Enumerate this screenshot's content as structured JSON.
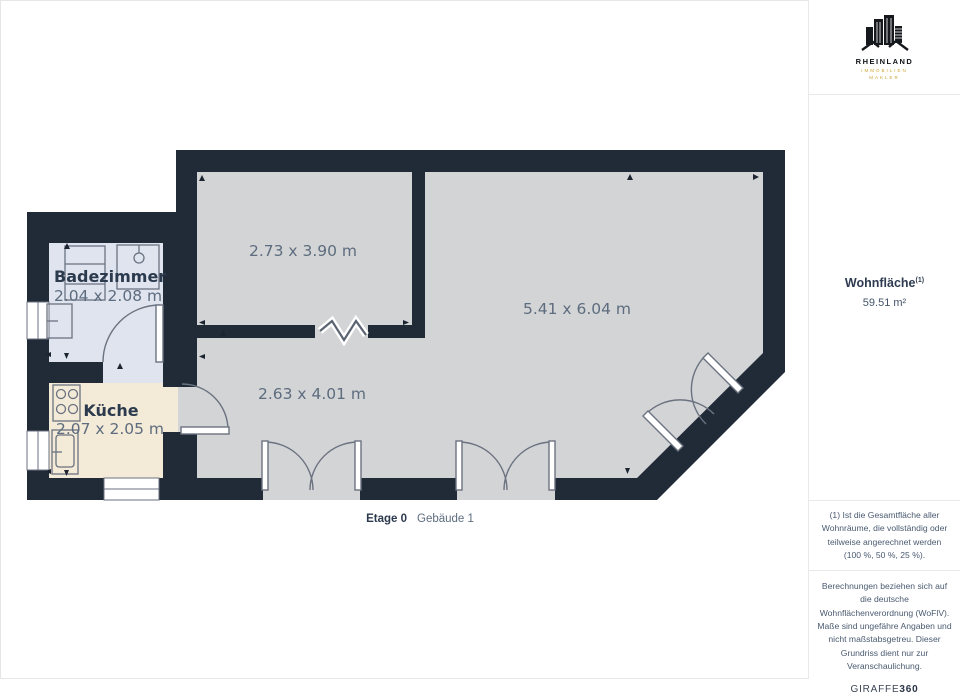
{
  "floorplan": {
    "rooms": [
      {
        "name": "Badezimmer",
        "dimensions": "2.04 x 2.08 m"
      },
      {
        "name": "Küche",
        "dimensions": "2.07 x 2.05 m"
      },
      {
        "name": "",
        "dimensions": "2.73 x 3.90 m"
      },
      {
        "name": "",
        "dimensions": "5.41 x 6.04 m"
      },
      {
        "name": "",
        "dimensions": "2.63 x 4.01 m"
      }
    ],
    "colors": {
      "wall": "#212b38",
      "floor": "#d3d4d6",
      "bathroom_floor": "#dfe4ef",
      "kitchen_floor": "#f3ead8",
      "door_line": "#6b7280",
      "label": "#2c3a4d",
      "dimension_text": "#5d6c7e"
    }
  },
  "caption": {
    "floor_label": "Etage 0",
    "building_label": "Gebäude 1"
  },
  "sidebar": {
    "logo": {
      "name": "RHEINLAND",
      "subtitle1": "IMMOBILIEN",
      "subtitle2": "MAKLER"
    },
    "area_title": "Wohnfläche",
    "area_superscript": "(1)",
    "area_value": "59.51 m²",
    "footnote1": "(1) Ist die Gesamtfläche aller Wohnräume, die vollständig oder teilweise angerechnet werden (100 %, 50 %, 25 %).",
    "footnote2": "Berechnungen beziehen sich auf die deutsche Wohnflächenverordnung (WoFlV). Maße sind ungefähre Angaben und nicht maßstabsgetreu. Dieser Grundriss dient nur zur Veranschaulichung.",
    "brand_name": "GIRAFFE",
    "brand_suffix": "360"
  }
}
